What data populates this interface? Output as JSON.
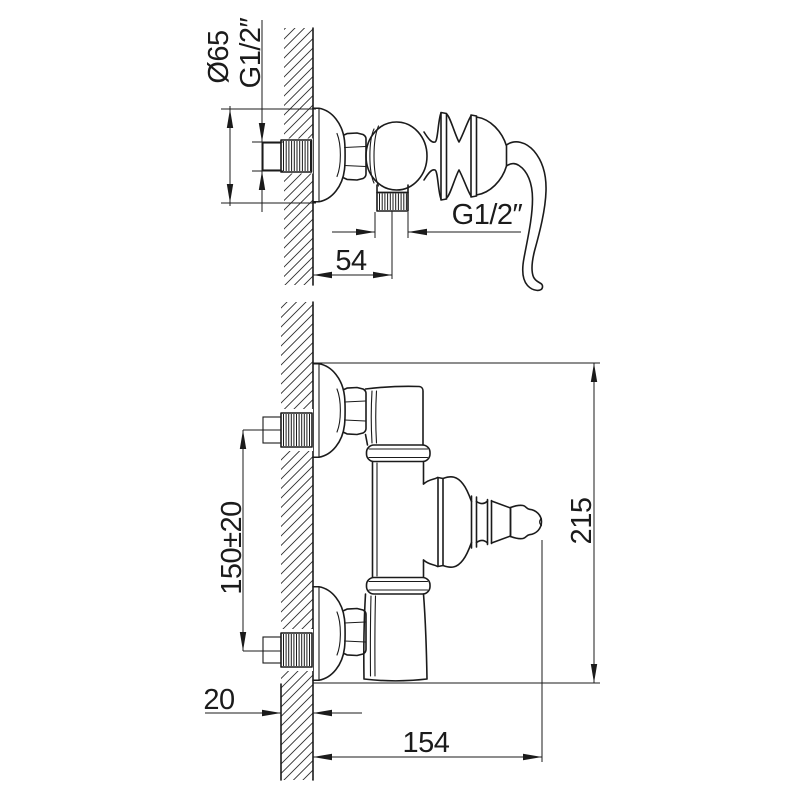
{
  "drawing": {
    "background": "#ffffff",
    "line_color": "#1b1b1b",
    "side_view": {
      "escutcheon_diameter": "Ø65",
      "wall_thread": "G1/2″",
      "outlet_thread": "G1/2″",
      "wall_to_outlet": "54"
    },
    "front_view": {
      "inlet_spacing": "150±20",
      "overall_height": "215",
      "wall_thickness": "20",
      "wall_to_handle": "154"
    }
  }
}
